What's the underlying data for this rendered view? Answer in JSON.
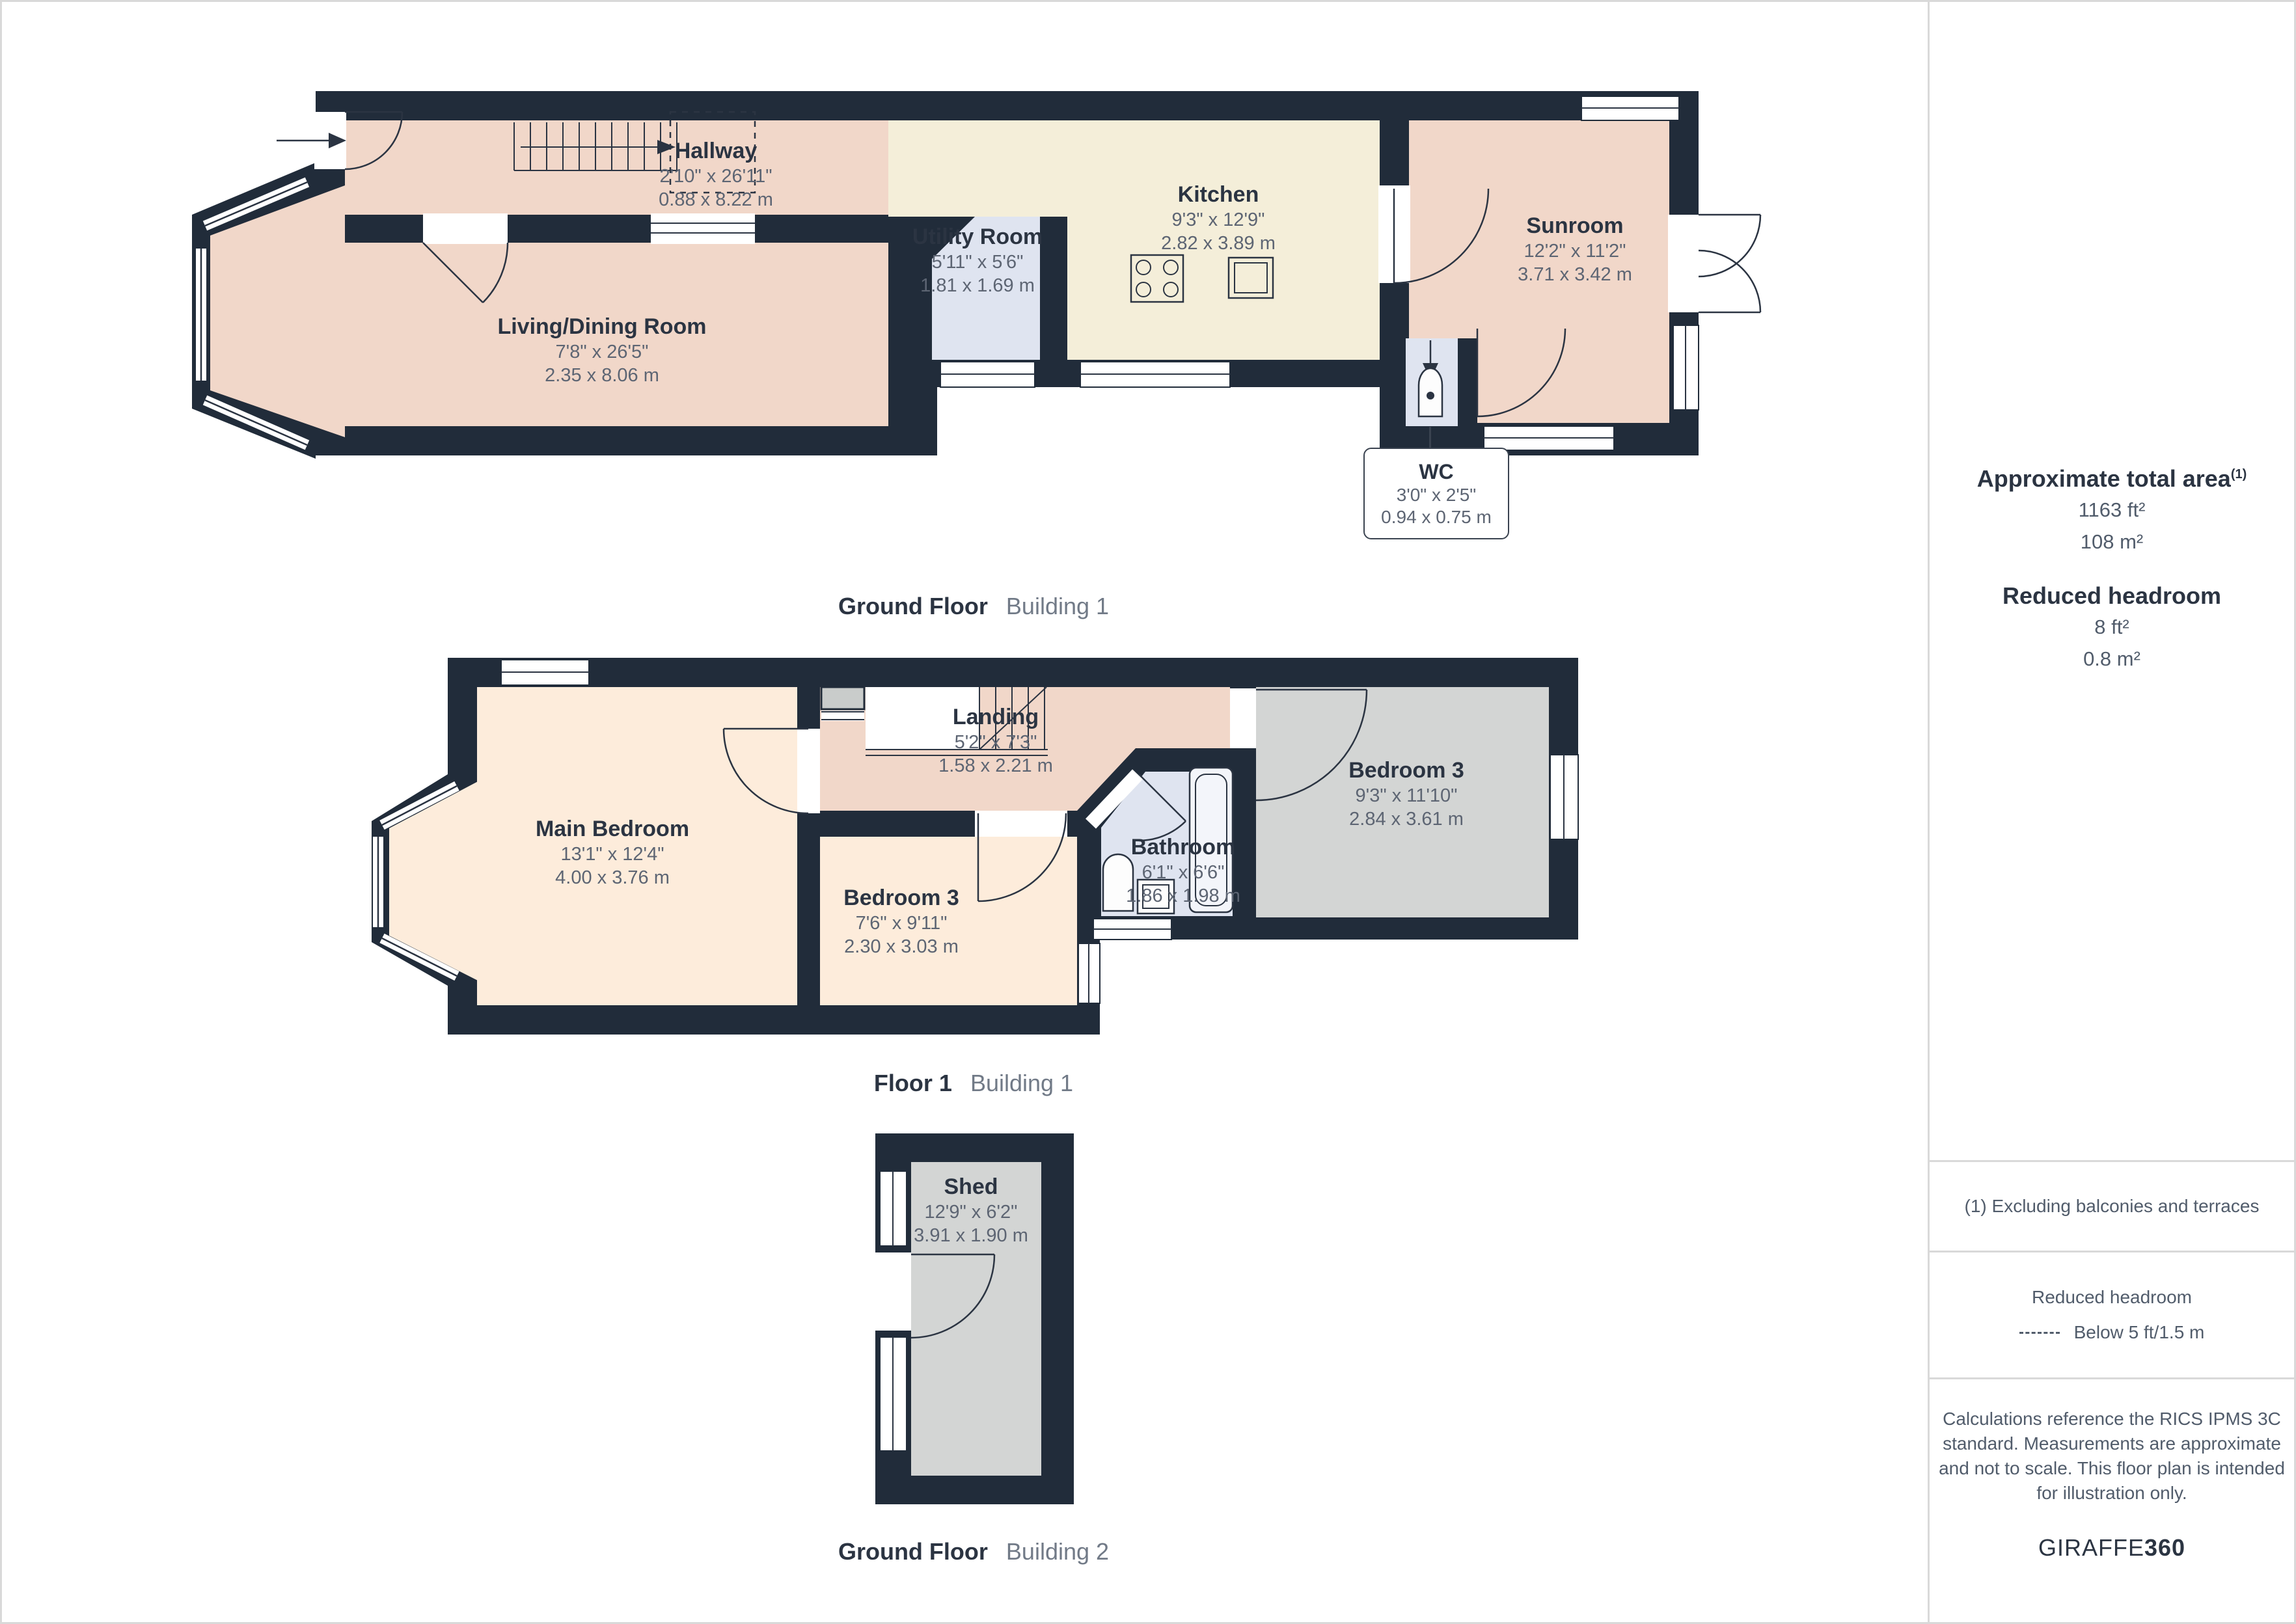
{
  "colors": {
    "wall": "#212c3a",
    "ink": "#2b3442",
    "dim": "#5d6573",
    "caption_light": "#717a87",
    "sidebar_text": "#515c6b",
    "border": "#d9d9d9",
    "room_pink": "#f1d7c9",
    "room_cream": "#f4eed9",
    "room_blue": "#dfe4f0",
    "room_peach": "#fdecdb",
    "room_gray": "#d3d5d4",
    "closet_gray": "#c9cccb"
  },
  "plans": [
    {
      "caption_bold": "Ground Floor",
      "caption_light": "Building 1",
      "rooms": [
        {
          "key": "hallway",
          "name": "Hallway",
          "dims_imperial": "2'10\" x 26'11\"",
          "dims_metric": "0.88 x 8.22 m"
        },
        {
          "key": "living-dining",
          "name": "Living/Dining Room",
          "dims_imperial": "7'8\" x 26'5\"",
          "dims_metric": "2.35 x 8.06 m"
        },
        {
          "key": "utility",
          "name": "Utility Room",
          "dims_imperial": "5'11\" x 5'6\"",
          "dims_metric": "1.81 x 1.69 m"
        },
        {
          "key": "kitchen",
          "name": "Kitchen",
          "dims_imperial": "9'3\" x 12'9\"",
          "dims_metric": "2.82 x 3.89 m"
        },
        {
          "key": "sunroom",
          "name": "Sunroom",
          "dims_imperial": "12'2\" x 11'2\"",
          "dims_metric": "3.71 x 3.42 m"
        },
        {
          "key": "wc",
          "name": "WC",
          "dims_imperial": "3'0\" x 2'5\"",
          "dims_metric": "0.94 x 0.75 m"
        }
      ]
    },
    {
      "caption_bold": "Floor 1",
      "caption_light": "Building 1",
      "rooms": [
        {
          "key": "main-bedroom",
          "name": "Main Bedroom",
          "dims_imperial": "13'1\" x 12'4\"",
          "dims_metric": "4.00 x 3.76 m"
        },
        {
          "key": "landing",
          "name": "Landing",
          "dims_imperial": "5'2\" x 7'3\"",
          "dims_metric": "1.58 x 2.21 m"
        },
        {
          "key": "bedroom3-right",
          "name": "Bedroom 3",
          "dims_imperial": "9'3\" x 11'10\"",
          "dims_metric": "2.84 x 3.61 m"
        },
        {
          "key": "bedroom3-mid",
          "name": "Bedroom 3",
          "dims_imperial": "7'6\" x 9'11\"",
          "dims_metric": "2.30 x 3.03 m"
        },
        {
          "key": "bathroom",
          "name": "Bathroom",
          "dims_imperial": "6'1\" x 6'6\"",
          "dims_metric": "1.86 x 1.98 m"
        }
      ]
    },
    {
      "caption_bold": "Ground Floor",
      "caption_light": "Building 2",
      "rooms": [
        {
          "key": "shed",
          "name": "Shed",
          "dims_imperial": "12'9\" x 6'2\"",
          "dims_metric": "3.91 x 1.90 m"
        }
      ]
    }
  ],
  "sidebar": {
    "total_area_title": "Approximate total area",
    "total_area_superscript": "(1)",
    "total_area_ft": "1163 ft²",
    "total_area_m": "108 m²",
    "reduced_headroom_title": "Reduced headroom",
    "reduced_headroom_ft": "8 ft²",
    "reduced_headroom_m": "0.8 m²",
    "footnote": "(1) Excluding balconies and terraces",
    "legend_title": "Reduced headroom",
    "legend_label": "Below 5 ft/1.5 m",
    "disclaimer": "Calculations reference the RICS IPMS 3C standard. Measurements are approximate and not to scale. This floor plan is intended for illustration only.",
    "brand_regular": "GIRAFFE",
    "brand_bold": "360"
  }
}
